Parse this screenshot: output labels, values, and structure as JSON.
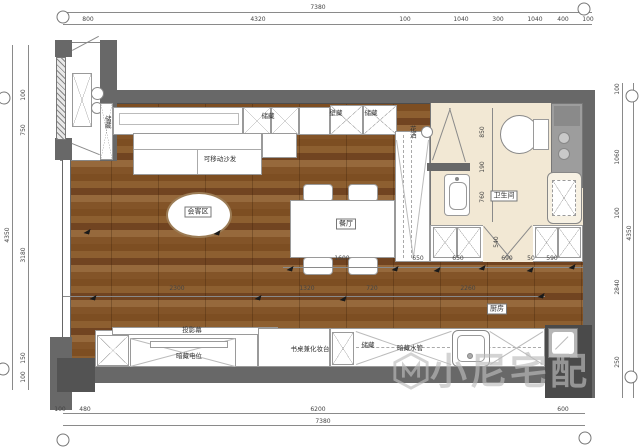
{
  "rooms": {
    "living": "会客区",
    "dining": "餐厅",
    "bathroom": "卫生间",
    "kitchen": "厨房"
  },
  "labels": [
    {
      "text": "储藏",
      "x": 107,
      "y": 122,
      "vert": true
    },
    {
      "text": "储藏",
      "x": 268,
      "y": 116
    },
    {
      "text": "壁藏",
      "x": 336,
      "y": 113
    },
    {
      "text": "储藏",
      "x": 371,
      "y": 113
    },
    {
      "text": "可移动沙发",
      "x": 220,
      "y": 159
    },
    {
      "text": "投影幕",
      "x": 192,
      "y": 330
    },
    {
      "text": "暗藏电位",
      "x": 189,
      "y": 356
    },
    {
      "text": "书桌兼化妆台",
      "x": 310,
      "y": 349
    },
    {
      "text": "储藏",
      "x": 368,
      "y": 345
    },
    {
      "text": "暗藏水管",
      "x": 410,
      "y": 348
    },
    {
      "text": "花洒",
      "x": 412,
      "y": 132,
      "vert": true
    }
  ],
  "dim_labels": [
    {
      "t": "7380",
      "x": 318,
      "y": 8
    },
    {
      "t": "800",
      "x": 88,
      "y": 20
    },
    {
      "t": "4320",
      "x": 258,
      "y": 20
    },
    {
      "t": "100",
      "x": 405,
      "y": 20
    },
    {
      "t": "1040",
      "x": 461,
      "y": 20
    },
    {
      "t": "300",
      "x": 498,
      "y": 20
    },
    {
      "t": "1040",
      "x": 535,
      "y": 20
    },
    {
      "t": "400",
      "x": 563,
      "y": 20
    },
    {
      "t": "100",
      "x": 588,
      "y": 20
    },
    {
      "t": "100",
      "x": 60,
      "y": 410
    },
    {
      "t": "480",
      "x": 85,
      "y": 410
    },
    {
      "t": "6200",
      "x": 318,
      "y": 410
    },
    {
      "t": "600",
      "x": 563,
      "y": 410
    },
    {
      "t": "7380",
      "x": 323,
      "y": 422
    },
    {
      "t": "100",
      "x": 24,
      "y": 95,
      "r": 1
    },
    {
      "t": "750",
      "x": 24,
      "y": 130,
      "r": 1
    },
    {
      "t": "3180",
      "x": 24,
      "y": 255,
      "r": 1
    },
    {
      "t": "150",
      "x": 24,
      "y": 358,
      "r": 1
    },
    {
      "t": "100",
      "x": 24,
      "y": 377,
      "r": 1
    },
    {
      "t": "4350",
      "x": 8,
      "y": 235,
      "r": 1
    },
    {
      "t": "100",
      "x": 618,
      "y": 89,
      "r": 1
    },
    {
      "t": "1060",
      "x": 618,
      "y": 157,
      "r": 1
    },
    {
      "t": "100",
      "x": 618,
      "y": 213,
      "r": 1
    },
    {
      "t": "2840",
      "x": 618,
      "y": 287,
      "r": 1
    },
    {
      "t": "250",
      "x": 618,
      "y": 362,
      "r": 1
    },
    {
      "t": "4350",
      "x": 630,
      "y": 233,
      "r": 1
    },
    {
      "t": "850",
      "x": 483,
      "y": 132,
      "r": 1
    },
    {
      "t": "190",
      "x": 483,
      "y": 167,
      "r": 1
    },
    {
      "t": "760",
      "x": 483,
      "y": 197,
      "r": 1
    },
    {
      "t": "540",
      "x": 497,
      "y": 242,
      "r": 1
    },
    {
      "t": "1600",
      "x": 342,
      "y": 259
    },
    {
      "t": "650",
      "x": 418,
      "y": 259
    },
    {
      "t": "650",
      "x": 458,
      "y": 259
    },
    {
      "t": "690",
      "x": 507,
      "y": 259
    },
    {
      "t": "50",
      "x": 531,
      "y": 259
    },
    {
      "t": "590",
      "x": 552,
      "y": 259
    },
    {
      "t": "2300",
      "x": 177,
      "y": 289
    },
    {
      "t": "1320",
      "x": 307,
      "y": 289
    },
    {
      "t": "720",
      "x": 372,
      "y": 289
    },
    {
      "t": "2260",
      "x": 468,
      "y": 289
    }
  ],
  "arrows": [
    [
      87,
      231
    ],
    [
      217,
      232
    ],
    [
      290,
      268
    ],
    [
      395,
      268
    ],
    [
      437,
      269
    ],
    [
      482,
      267
    ],
    [
      530,
      269
    ],
    [
      572,
      266
    ],
    [
      93,
      297
    ],
    [
      258,
      297
    ],
    [
      343,
      298
    ],
    [
      541,
      295
    ]
  ],
  "axis_bubbles": [
    [
      63,
      17
    ],
    [
      584,
      9
    ],
    [
      4,
      98
    ],
    [
      632,
      96
    ],
    [
      3,
      369
    ],
    [
      631,
      377
    ],
    [
      63,
      440
    ],
    [
      585,
      438
    ]
  ],
  "watermark": {
    "text": "小尼宅配"
  },
  "colors": {
    "wall": "#686868",
    "wall_dark": "#535353",
    "wood": "#85562a",
    "bath_floor": "#f2e8d4",
    "counter_gray": "#9d9d9d",
    "corner_dark": "#4a4a4a",
    "watermark_gray": "#bcbcbc"
  }
}
